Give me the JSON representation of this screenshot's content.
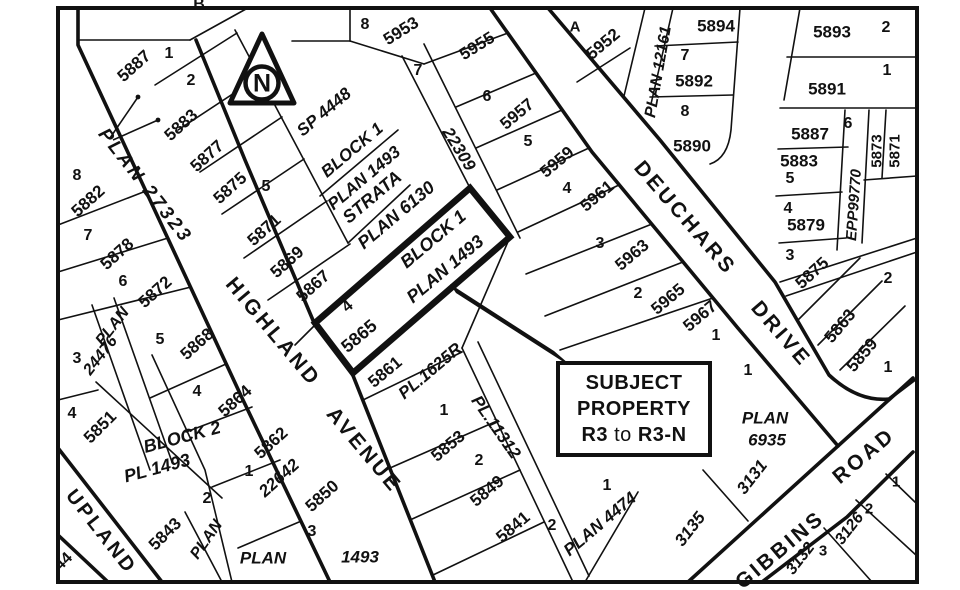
{
  "map_title": "Zoning subject property map",
  "subject_label": {
    "line1": "SUBJECT",
    "line2": "PROPERTY",
    "r3": "R3",
    "to": "to",
    "r3n": "R3-N"
  },
  "north": {
    "letter": "N"
  },
  "colors": {
    "ink": "#111111",
    "paper": "#ffffff"
  },
  "streets": [
    {
      "t": "PLAN  27323",
      "x": 145,
      "y": 186,
      "r": 52,
      "s": 19,
      "i": true
    },
    {
      "t": "HIGHLAND",
      "x": 273,
      "y": 332,
      "r": 50,
      "s": 21,
      "i": false
    },
    {
      "t": "AVENUE",
      "x": 364,
      "y": 450,
      "r": 50,
      "s": 21,
      "i": false
    },
    {
      "t": "UPLAND",
      "x": 101,
      "y": 532,
      "r": 52,
      "s": 20,
      "i": false
    },
    {
      "t": "DEUCHARS",
      "x": 685,
      "y": 218,
      "r": 49,
      "s": 21,
      "i": false
    },
    {
      "t": "DRIVE",
      "x": 781,
      "y": 334,
      "r": 49,
      "s": 21,
      "i": false
    },
    {
      "t": "GIBBINS",
      "x": 780,
      "y": 550,
      "r": -40,
      "s": 21,
      "i": false
    },
    {
      "t": "ROAD",
      "x": 864,
      "y": 456,
      "r": -40,
      "s": 21,
      "i": false
    }
  ],
  "labels": [
    {
      "t": "B",
      "x": 199,
      "y": 5,
      "r": 0,
      "s": 16
    },
    {
      "t": "8",
      "x": 365,
      "y": 25,
      "r": 0,
      "s": 16
    },
    {
      "t": "5953",
      "x": 401,
      "y": 31,
      "r": -32,
      "s": 17
    },
    {
      "t": "7",
      "x": 418,
      "y": 71,
      "r": 0,
      "s": 16
    },
    {
      "t": "5955",
      "x": 477,
      "y": 46,
      "r": -32,
      "s": 17
    },
    {
      "t": "A",
      "x": 575,
      "y": 27,
      "r": 0,
      "s": 15
    },
    {
      "t": "5952",
      "x": 603,
      "y": 44,
      "r": -40,
      "s": 17
    },
    {
      "t": "22309",
      "x": 459,
      "y": 149,
      "r": 58,
      "s": 17,
      "i": true
    },
    {
      "t": "6",
      "x": 487,
      "y": 97,
      "r": 0,
      "s": 16
    },
    {
      "t": "5957",
      "x": 517,
      "y": 114,
      "r": -40,
      "s": 17
    },
    {
      "t": "5",
      "x": 528,
      "y": 142,
      "r": 0,
      "s": 16
    },
    {
      "t": "5959",
      "x": 557,
      "y": 162,
      "r": -40,
      "s": 17
    },
    {
      "t": "4",
      "x": 567,
      "y": 189,
      "r": 0,
      "s": 16
    },
    {
      "t": "5961",
      "x": 597,
      "y": 196,
      "r": -40,
      "s": 17
    },
    {
      "t": "3",
      "x": 600,
      "y": 244,
      "r": 0,
      "s": 16
    },
    {
      "t": "5963",
      "x": 632,
      "y": 255,
      "r": -40,
      "s": 17
    },
    {
      "t": "2",
      "x": 638,
      "y": 294,
      "r": 0,
      "s": 16
    },
    {
      "t": "5965",
      "x": 668,
      "y": 299,
      "r": -40,
      "s": 17
    },
    {
      "t": "5967",
      "x": 700,
      "y": 316,
      "r": -40,
      "s": 17
    },
    {
      "t": "1",
      "x": 716,
      "y": 336,
      "r": 0,
      "s": 16
    },
    {
      "t": "5887",
      "x": 134,
      "y": 66,
      "r": -42,
      "s": 17
    },
    {
      "t": "1",
      "x": 169,
      "y": 54,
      "r": 0,
      "s": 16
    },
    {
      "t": "2",
      "x": 191,
      "y": 81,
      "r": 0,
      "s": 16
    },
    {
      "t": "5883",
      "x": 181,
      "y": 125,
      "r": -42,
      "s": 17
    },
    {
      "t": "5877",
      "x": 207,
      "y": 156,
      "r": -42,
      "s": 17
    },
    {
      "t": "5875",
      "x": 230,
      "y": 188,
      "r": -42,
      "s": 17
    },
    {
      "t": "5",
      "x": 266,
      "y": 187,
      "r": 0,
      "s": 16
    },
    {
      "t": "5871",
      "x": 264,
      "y": 230,
      "r": -42,
      "s": 17
    },
    {
      "t": "SP 4448",
      "x": 324,
      "y": 112,
      "r": -40,
      "s": 17,
      "i": true
    },
    {
      "t": "BLOCK 1",
      "x": 352,
      "y": 150,
      "r": -40,
      "s": 17,
      "i": true
    },
    {
      "t": "PLAN 1493",
      "x": 364,
      "y": 178,
      "r": -40,
      "s": 17,
      "i": true
    },
    {
      "t": "STRATA",
      "x": 372,
      "y": 197,
      "r": -40,
      "s": 18,
      "i": true
    },
    {
      "t": "PLAN 6130",
      "x": 396,
      "y": 215,
      "r": -40,
      "s": 18,
      "i": true
    },
    {
      "t": "5869",
      "x": 287,
      "y": 262,
      "r": -42,
      "s": 17
    },
    {
      "t": "5867",
      "x": 313,
      "y": 286,
      "r": -42,
      "s": 17
    },
    {
      "t": "4",
      "x": 348,
      "y": 307,
      "r": -40,
      "s": 16
    },
    {
      "t": "5865",
      "x": 359,
      "y": 336,
      "r": -40,
      "s": 18
    },
    {
      "t": "BLOCK 1",
      "x": 433,
      "y": 239,
      "r": -40,
      "s": 18,
      "i": true
    },
    {
      "t": "PLAN 1493",
      "x": 445,
      "y": 269,
      "r": -40,
      "s": 18,
      "i": true
    },
    {
      "t": "5861",
      "x": 385,
      "y": 372,
      "r": -40,
      "s": 17
    },
    {
      "t": "PL.1625R",
      "x": 430,
      "y": 371,
      "r": -40,
      "s": 17,
      "i": true
    },
    {
      "t": "1",
      "x": 444,
      "y": 411,
      "r": 0,
      "s": 16
    },
    {
      "t": "5853",
      "x": 448,
      "y": 446,
      "r": -40,
      "s": 17
    },
    {
      "t": "PL.11312",
      "x": 496,
      "y": 427,
      "r": 55,
      "s": 17,
      "i": true
    },
    {
      "t": "2",
      "x": 479,
      "y": 461,
      "r": 0,
      "s": 16
    },
    {
      "t": "5849",
      "x": 487,
      "y": 491,
      "r": -40,
      "s": 17
    },
    {
      "t": "5841",
      "x": 513,
      "y": 527,
      "r": -40,
      "s": 17
    },
    {
      "t": "2",
      "x": 552,
      "y": 526,
      "r": 0,
      "s": 16
    },
    {
      "t": "PLAN  4474",
      "x": 600,
      "y": 524,
      "r": -40,
      "s": 17,
      "i": true
    },
    {
      "t": "1",
      "x": 607,
      "y": 486,
      "r": 0,
      "s": 16
    },
    {
      "t": "8",
      "x": 77,
      "y": 176,
      "r": 0,
      "s": 16
    },
    {
      "t": "5882",
      "x": 88,
      "y": 201,
      "r": -42,
      "s": 17
    },
    {
      "t": "7",
      "x": 88,
      "y": 236,
      "r": 0,
      "s": 16
    },
    {
      "t": "5878",
      "x": 117,
      "y": 254,
      "r": -42,
      "s": 17
    },
    {
      "t": "6",
      "x": 123,
      "y": 282,
      "r": 0,
      "s": 16
    },
    {
      "t": "5872",
      "x": 155,
      "y": 292,
      "r": -42,
      "s": 17
    },
    {
      "t": "PLAN",
      "x": 113,
      "y": 327,
      "r": -52,
      "s": 16,
      "i": true
    },
    {
      "t": "24476",
      "x": 101,
      "y": 356,
      "r": -52,
      "s": 16,
      "i": true
    },
    {
      "t": "3",
      "x": 77,
      "y": 359,
      "r": 0,
      "s": 16
    },
    {
      "t": "5",
      "x": 160,
      "y": 340,
      "r": 0,
      "s": 16
    },
    {
      "t": "5868",
      "x": 197,
      "y": 344,
      "r": -42,
      "s": 17
    },
    {
      "t": "4",
      "x": 72,
      "y": 414,
      "r": 0,
      "s": 16
    },
    {
      "t": "5851",
      "x": 100,
      "y": 427,
      "r": -45,
      "s": 17
    },
    {
      "t": "4",
      "x": 197,
      "y": 392,
      "r": 0,
      "s": 16
    },
    {
      "t": "5864",
      "x": 235,
      "y": 401,
      "r": -42,
      "s": 17
    },
    {
      "t": "BLOCK  2",
      "x": 182,
      "y": 437,
      "r": -15,
      "s": 18,
      "i": true
    },
    {
      "t": "PL  1493",
      "x": 157,
      "y": 468,
      "r": -15,
      "s": 18,
      "i": true
    },
    {
      "t": "5862",
      "x": 271,
      "y": 443,
      "r": -42,
      "s": 17
    },
    {
      "t": "1",
      "x": 249,
      "y": 472,
      "r": 0,
      "s": 16
    },
    {
      "t": "22642",
      "x": 279,
      "y": 478,
      "r": -42,
      "s": 17,
      "i": true
    },
    {
      "t": "2",
      "x": 207,
      "y": 499,
      "r": 0,
      "s": 16
    },
    {
      "t": "5843",
      "x": 165,
      "y": 534,
      "r": -45,
      "s": 17
    },
    {
      "t": "PLAN",
      "x": 207,
      "y": 540,
      "r": -55,
      "s": 16,
      "i": true
    },
    {
      "t": "5850",
      "x": 322,
      "y": 496,
      "r": -42,
      "s": 17
    },
    {
      "t": "3",
      "x": 312,
      "y": 532,
      "r": 0,
      "s": 16
    },
    {
      "t": "PLAN",
      "x": 263,
      "y": 558,
      "r": 0,
      "s": 17,
      "i": true
    },
    {
      "t": "1493",
      "x": 360,
      "y": 557,
      "r": 0,
      "s": 17,
      "i": true
    },
    {
      "t": "44",
      "x": 64,
      "y": 562,
      "r": -45,
      "s": 16
    },
    {
      "t": "PLAN 12161",
      "x": 659,
      "y": 72,
      "r": -80,
      "s": 16,
      "i": true
    },
    {
      "t": "5894",
      "x": 716,
      "y": 26,
      "r": 0,
      "s": 17
    },
    {
      "t": "7",
      "x": 685,
      "y": 56,
      "r": 0,
      "s": 16
    },
    {
      "t": "5892",
      "x": 694,
      "y": 81,
      "r": 0,
      "s": 17
    },
    {
      "t": "8",
      "x": 685,
      "y": 112,
      "r": 0,
      "s": 16
    },
    {
      "t": "5890",
      "x": 692,
      "y": 146,
      "r": 0,
      "s": 17
    },
    {
      "t": "5893",
      "x": 832,
      "y": 32,
      "r": 0,
      "s": 17
    },
    {
      "t": "2",
      "x": 886,
      "y": 28,
      "r": 0,
      "s": 16
    },
    {
      "t": "5891",
      "x": 827,
      "y": 89,
      "r": 0,
      "s": 17
    },
    {
      "t": "1",
      "x": 887,
      "y": 71,
      "r": 0,
      "s": 16
    },
    {
      "t": "5887",
      "x": 810,
      "y": 134,
      "r": 0,
      "s": 17
    },
    {
      "t": "6",
      "x": 848,
      "y": 124,
      "r": 0,
      "s": 16
    },
    {
      "t": "5883",
      "x": 799,
      "y": 161,
      "r": 0,
      "s": 17
    },
    {
      "t": "5",
      "x": 790,
      "y": 179,
      "r": 0,
      "s": 16
    },
    {
      "t": "EPP99770",
      "x": 854,
      "y": 205,
      "r": -86,
      "s": 15,
      "i": true
    },
    {
      "t": "5873",
      "x": 877,
      "y": 151,
      "r": -90,
      "s": 15
    },
    {
      "t": "5871",
      "x": 895,
      "y": 151,
      "r": -90,
      "s": 15
    },
    {
      "t": "4",
      "x": 788,
      "y": 209,
      "r": 0,
      "s": 16
    },
    {
      "t": "5879",
      "x": 806,
      "y": 225,
      "r": 0,
      "s": 17
    },
    {
      "t": "3",
      "x": 790,
      "y": 256,
      "r": 0,
      "s": 16
    },
    {
      "t": "5875",
      "x": 812,
      "y": 273,
      "r": -42,
      "s": 17
    },
    {
      "t": "2",
      "x": 888,
      "y": 279,
      "r": 0,
      "s": 16
    },
    {
      "t": "5863",
      "x": 840,
      "y": 326,
      "r": -50,
      "s": 17
    },
    {
      "t": "5859",
      "x": 862,
      "y": 355,
      "r": -50,
      "s": 17
    },
    {
      "t": "1",
      "x": 888,
      "y": 368,
      "r": 0,
      "s": 16
    },
    {
      "t": "1",
      "x": 748,
      "y": 371,
      "r": 0,
      "s": 16
    },
    {
      "t": "PLAN",
      "x": 765,
      "y": 418,
      "r": 0,
      "s": 17,
      "i": true
    },
    {
      "t": "6935",
      "x": 767,
      "y": 440,
      "r": 0,
      "s": 17,
      "i": true
    },
    {
      "t": "3131",
      "x": 752,
      "y": 477,
      "r": -52,
      "s": 17,
      "i": true
    },
    {
      "t": "3135",
      "x": 690,
      "y": 529,
      "r": -52,
      "s": 17,
      "i": true
    },
    {
      "t": "3132",
      "x": 801,
      "y": 559,
      "r": -52,
      "s": 16,
      "i": true
    },
    {
      "t": "3",
      "x": 823,
      "y": 551,
      "r": 0,
      "s": 15
    },
    {
      "t": "3126",
      "x": 850,
      "y": 529,
      "r": -52,
      "s": 16,
      "i": true
    },
    {
      "t": "2",
      "x": 869,
      "y": 509,
      "r": 0,
      "s": 15
    },
    {
      "t": "1",
      "x": 896,
      "y": 482,
      "r": 0,
      "s": 15
    }
  ]
}
